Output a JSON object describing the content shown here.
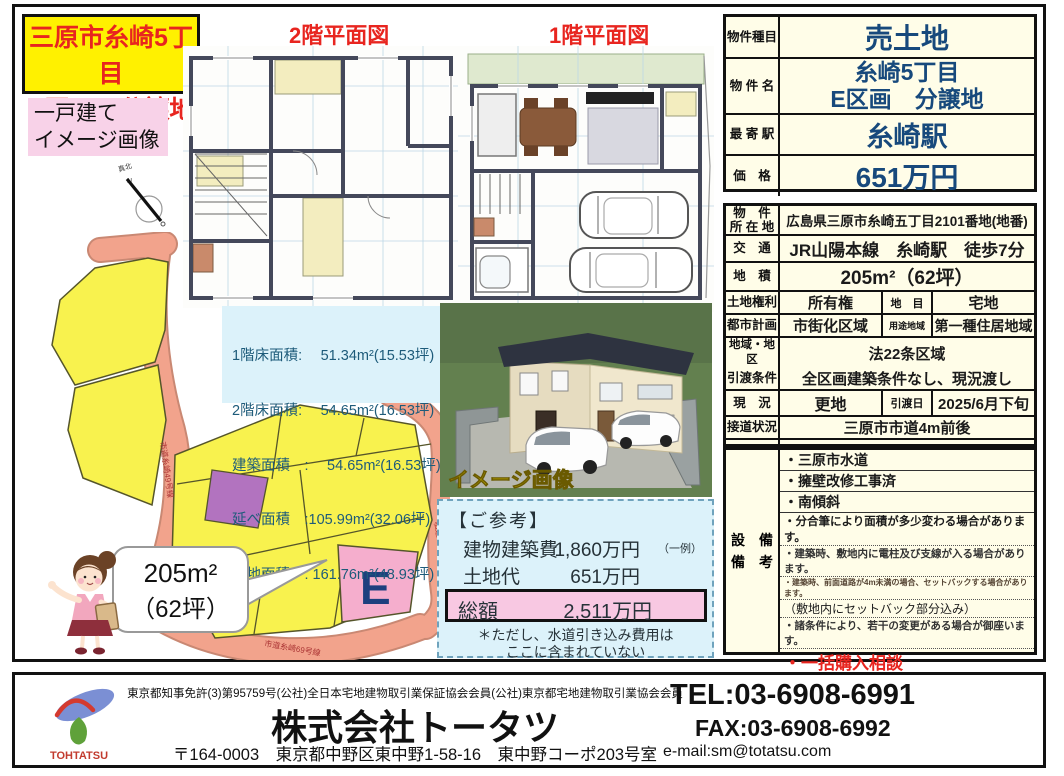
{
  "colors": {
    "title_red": "#e8251f",
    "title_bg": "#fff100",
    "pink_label_bg": "#f8d2e8",
    "value_blue": "#17497c",
    "table_bg": "#fffde8",
    "highlight_pink": "#f8c8e2",
    "info_bg": "#dcf2fa",
    "map_yellow": "#f8f24e",
    "map_road": "#f2a38c",
    "map_pink": "#f5aecd",
    "map_purple": "#b273bf",
    "remark_red": "#e8251f"
  },
  "title_box": {
    "line1": "三原市糸崎5丁目",
    "line2": "E区画　分譲地"
  },
  "image_label": {
    "line1": "一戸建て",
    "line2": "イメージ画像"
  },
  "plan_labels": {
    "floor2": "2階平面図",
    "floor1": "1階平面図"
  },
  "areas": {
    "lines": [
      "1階床面積:　 51.34m²(15.53坪)",
      "2階床面積:　 54.65m²(16.53坪)",
      "建築面積　:　 54.65m²(16.53坪)",
      "延べ面積　:105.99m²(32.06坪)",
      "敷地面積　: 161.76m²(48.93坪)"
    ]
  },
  "house_image_label": "イメージ画像",
  "map": {
    "parcel_letter": "E",
    "bubble_area": "205m²",
    "bubble_tsubo": "（62坪）",
    "road_left": "市道糸崎49号線",
    "road_bottom": "市道糸崎69号線",
    "road_right": "私道",
    "compass_label": "真北",
    "compass_n": "N"
  },
  "reference": {
    "heading": "【ご参考】",
    "row1_label": "建物建築費",
    "row1_value": "1,860万円",
    "row1_note": "（一例）",
    "row2_label": "土地代",
    "row2_value": "651万円",
    "total_label": "総額",
    "total_value": "2,511万円",
    "note1": "＊ただし、水道引き込み費用は",
    "note2": "ここに含まれていない"
  },
  "summary_table": {
    "rows": [
      {
        "label": "物件種目",
        "value": "売土地"
      },
      {
        "label": "物 件 名",
        "value_line1": "糸崎5丁目",
        "value_line2": "E区画　分譲地"
      },
      {
        "label": "最 寄 駅",
        "value": "糸崎駅"
      },
      {
        "label": "価　格",
        "value": "651万円"
      }
    ]
  },
  "detail_table": {
    "rows": [
      {
        "label_line1": "物　件",
        "label_line2": "所 在 地",
        "value": "広島県三原市糸崎五丁目2101番地(地番)"
      },
      {
        "label": "交　通",
        "value": "JR山陽本線　糸崎駅　徒歩7分"
      },
      {
        "label": "地　積",
        "value": "205m²（62坪）"
      },
      {
        "label": "土地権利",
        "value": "所有権",
        "label2": "地　目",
        "value2": "宅地"
      },
      {
        "label": "都市計画",
        "value": "市街化区域",
        "label2": "用途地域",
        "value2": "第一種住居地域"
      },
      {
        "label": "地域・地区",
        "value": "法22条区域"
      },
      {
        "label": "引渡条件",
        "value": "全区画建築条件なし、現況渡し"
      },
      {
        "label": "現　況",
        "value": "更地",
        "label2": "引渡日",
        "value2": "2025/6月下旬"
      },
      {
        "label": "接道状況",
        "value": "三原市市道4m前後"
      }
    ]
  },
  "remarks": {
    "label_line1": "設　備",
    "label_line2": "備　考",
    "items": [
      "・三原市水道",
      "・擁壁改修工事済",
      "・南傾斜",
      "・分合筆により面積が多少変わる場合があります。",
      "・建築時、敷地内に電柱及び支線が入る場合があります。",
      "・建築時、前面道路が4m未満の場合、セットバックする場合があります。",
      "（敷地内にセットバック部分込み）",
      "・諸条件により、若干の変更がある場合が御座います。",
      "・一括購入相談"
    ]
  },
  "footer": {
    "license": "東京都知事免許(3)第95759号(公社)全日本宅地建物取引業保証協会会員(公社)東京都宅地建物取引業協会会員",
    "company": "株式会社トータツ",
    "address": "〒164-0003　東京都中野区東中野1-58-16　東中野コーポ203号室",
    "tel": "TEL:03-6908-6991",
    "fax": "FAX:03-6908-6992",
    "email": "e-mail:sm@totatsu.com",
    "logo_text": "TOHTATSU"
  }
}
